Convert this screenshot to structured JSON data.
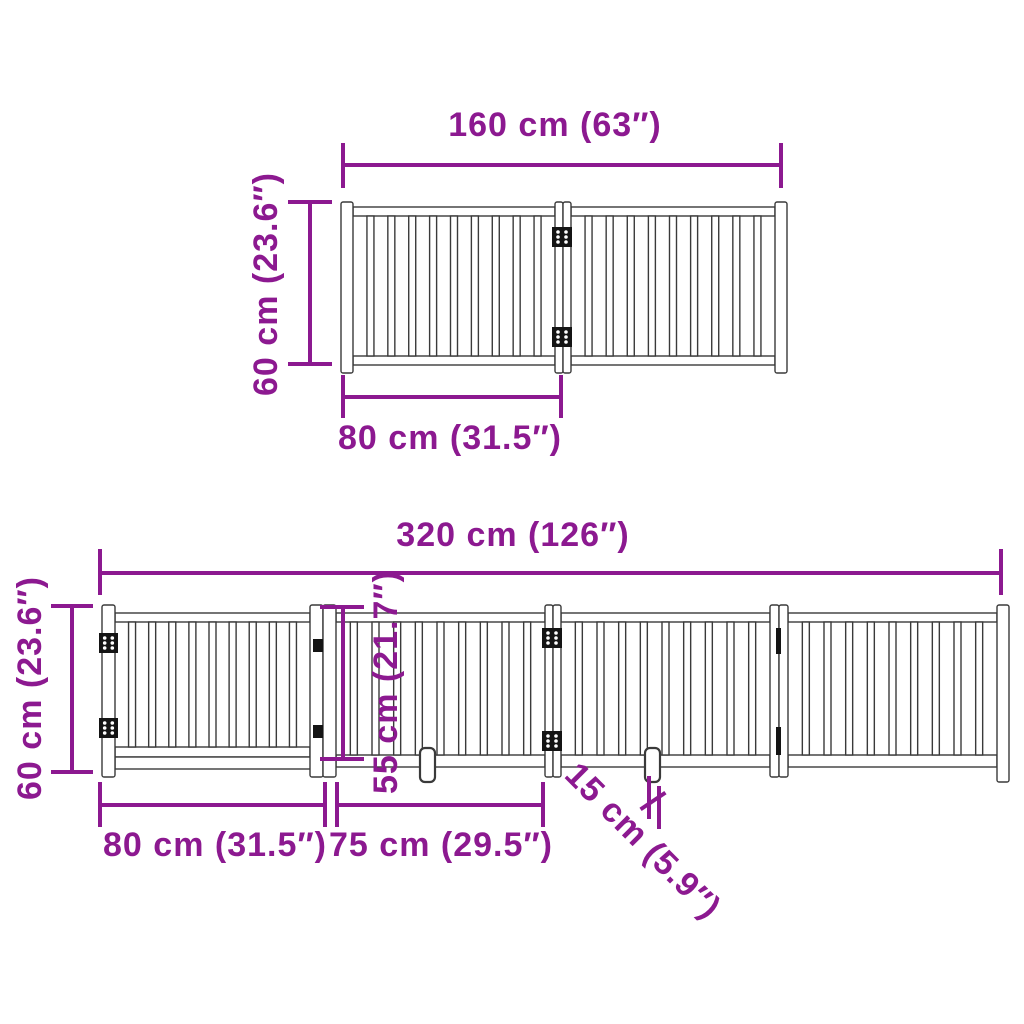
{
  "colors": {
    "dimension": "#8C1990",
    "outline": "#3A3A3A",
    "hinge": "#141414",
    "background": "#FFFFFF"
  },
  "top_diagram": {
    "total_width_label": "160 cm (63″)",
    "height_label": "60 cm (23.6″)",
    "panel_width_label": "80 cm (31.5″)"
  },
  "bottom_diagram": {
    "total_width_label": "320 cm (126″)",
    "height_label": "60 cm (23.6″)",
    "door_width_label": "80 cm (31.5″)",
    "panel_width_label": "75 cm (29.5″)",
    "inner_height_label": "55 cm (21.7″)",
    "foot_label": "15 cm (5.9″)"
  },
  "figure": {
    "stroke": "#3A3A3A",
    "hinge_fill": "#141414",
    "fences": [
      {
        "name": "two-panel-fence",
        "post_y": 202,
        "post_h": 171,
        "rail_top_y": 207,
        "rail_h": 9,
        "rail_bottom_y": 356,
        "rail_bottom_h": 9,
        "slat_top": 216,
        "slat_bottom": 356,
        "posts": [
          {
            "x": 341,
            "w": 12
          },
          {
            "x": 555,
            "w": 8
          },
          {
            "x": 563,
            "w": 8
          },
          {
            "x": 775,
            "w": 12
          }
        ],
        "panels": [
          {
            "x1": 353,
            "x2": 555,
            "slats": 9
          },
          {
            "x1": 571,
            "x2": 775,
            "slats": 9
          }
        ],
        "extra_rails": [],
        "hinges": [
          {
            "x": 552,
            "y": 227,
            "w": 20,
            "h": 20
          },
          {
            "x": 552,
            "y": 327,
            "w": 20,
            "h": 20
          }
        ],
        "marks": [],
        "feet": []
      },
      {
        "name": "four-panel-fence-with-door",
        "post_y": 605,
        "post_h": 172,
        "rail_top_y": 613,
        "rail_h": 9,
        "rail_bottom_y": 755,
        "rail_bottom_h": 12,
        "slat_top": 622,
        "slat_bottom": 755,
        "posts": [
          {
            "x": 102,
            "w": 13
          },
          {
            "x": 310,
            "w": 13
          },
          {
            "x": 323,
            "w": 13
          },
          {
            "x": 545,
            "w": 8
          },
          {
            "x": 553,
            "w": 8
          },
          {
            "x": 770,
            "w": 9
          },
          {
            "x": 779,
            "w": 9
          },
          {
            "x": 997,
            "w": 12,
            "h": 177
          }
        ],
        "panels": [
          {
            "x1": 115,
            "x2": 310,
            "slats": 9,
            "slat_bottom": 747,
            "rail_bottom_y": 747,
            "rail_bottom_h": 10
          },
          {
            "x1": 336,
            "x2": 545,
            "slats": 9
          },
          {
            "x1": 561,
            "x2": 770,
            "slats": 9
          },
          {
            "x1": 788,
            "x2": 997,
            "slats": 9
          }
        ],
        "extra_rails": [
          {
            "x": 115,
            "y": 757,
            "w": 196,
            "h": 12
          }
        ],
        "hinges": [
          {
            "x": 99,
            "y": 633,
            "w": 19,
            "h": 20
          },
          {
            "x": 99,
            "y": 718,
            "w": 19,
            "h": 20
          },
          {
            "x": 542,
            "y": 628,
            "w": 20,
            "h": 20
          },
          {
            "x": 542,
            "y": 731,
            "w": 20,
            "h": 20
          }
        ],
        "marks": [
          {
            "x": 313,
            "y": 639,
            "w": 10,
            "h": 13
          },
          {
            "x": 313,
            "y": 725,
            "w": 10,
            "h": 13
          },
          {
            "x": 776,
            "y": 628,
            "w": 5,
            "h": 26
          },
          {
            "x": 776,
            "y": 727,
            "w": 5,
            "h": 28
          }
        ],
        "feet": [
          {
            "x": 420,
            "y": 748,
            "w": 15,
            "h": 34
          },
          {
            "x": 645,
            "y": 748,
            "w": 15,
            "h": 34
          }
        ]
      }
    ]
  }
}
